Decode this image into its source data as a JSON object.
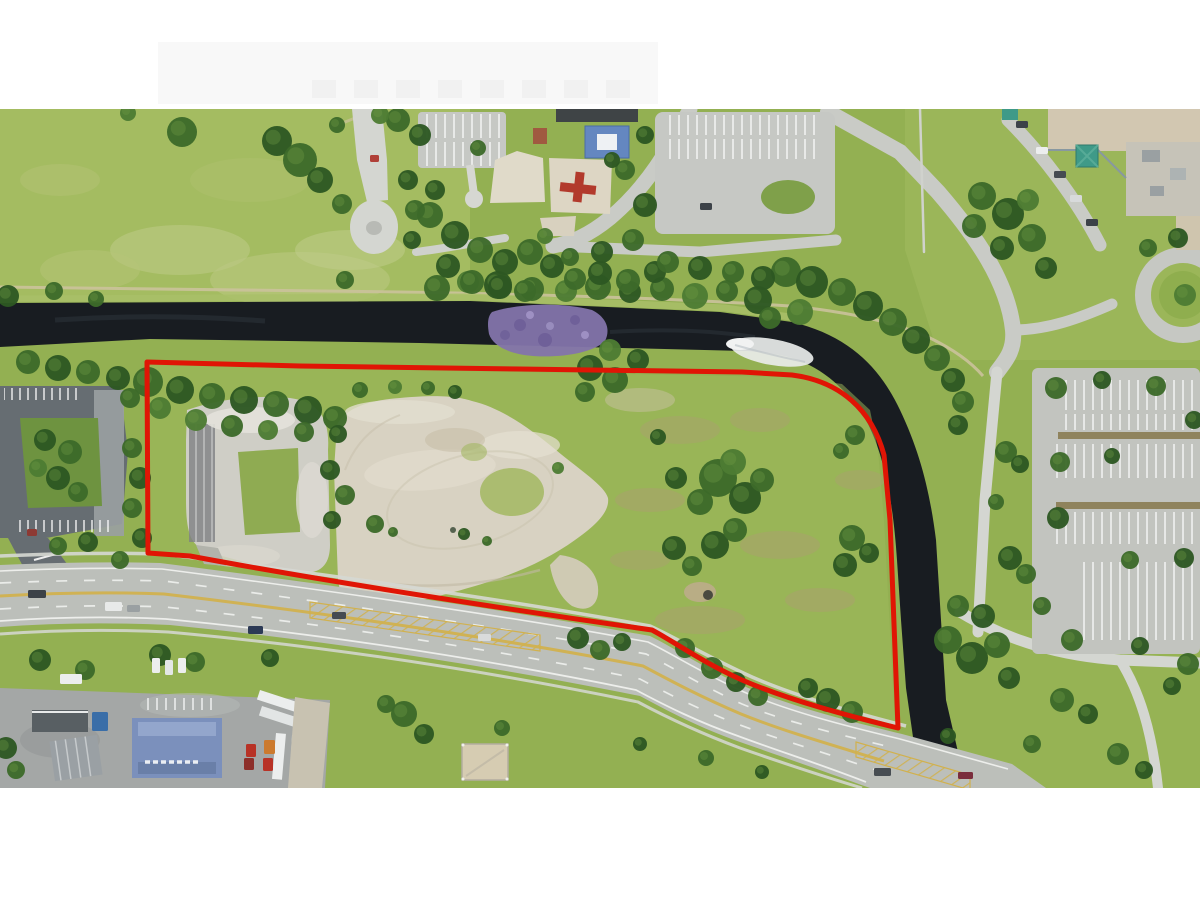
{
  "meta": {
    "description": "Aerial drone photograph of a vacant commercial land parcel outlined in red, bounded by a dark canal on the north and east, a multi-lane road on the south, with a public park, playground and parking lots surrounding it",
    "image_width": 1200,
    "image_height": 900,
    "photo_top": 109,
    "photo_bottom": 788
  },
  "annotation": {
    "type": "property-boundary",
    "color": "#e01505",
    "stroke_width": 5,
    "path": "M147,362 L300,366 L520,369 L742,372 L792,375 C840,381 872,410 884,455 L890,520 L898,728 C848,716 788,700 742,680 C702,662 678,644 652,630 C540,614 340,584 190,556 L148,553 Z"
  },
  "canal": {
    "color": "#181c21",
    "path": "M0,303 L470,301 L720,312 L792,322 C850,336 880,368 900,410 C920,452 930,492 936,540 L941,620 L946,700 L958,752 L972,788 L926,788 L914,744 L906,688 L901,620 L897,560 C893,500 884,456 868,424 C850,392 824,368 792,358 C770,352 750,351 744,351 L420,343 L150,339 L0,347 Z",
    "vegetation_color": "#8374ab",
    "whitewater_color": "#e9ebea"
  },
  "main_road": {
    "color": "#bcbfba",
    "path": "M0,565 Q90,561 160,563 C340,586 520,612 650,636 C678,650 704,668 746,687 C792,707 852,722 902,734 L1012,764 L1046,788 L870,788 C820,770 780,756 740,742 C700,728 670,712 640,696 C500,668 340,642 170,625 Q80,621 0,627 Z",
    "median_yellow": "#d1b14e",
    "marking_white": "#f2f3f1"
  },
  "parcel_interior": {
    "sand_color": "#d8d2c2",
    "sand_path": "M337,425 C345,408 370,400 400,398 C440,394 460,397 472,401 C502,408 532,430 556,450 C580,470 605,486 608,498 C610,512 595,526 575,540 C550,558 520,572 488,582 C450,594 410,604 380,607 C355,609 340,600 338,580 L334,470 Z",
    "sand_tail_path": "M560,555 C585,558 600,574 598,594 C596,608 585,612 572,606 C560,598 552,580 550,565 Z",
    "gravel_color": "#cfcec6"
  },
  "colors": {
    "grass_base": "#93b052",
    "field_light": "#a4bd62",
    "mottle_light": "#bcc983",
    "lawn_right": "#9cb75a",
    "path_gray": "#c9cbc6",
    "path_light": "#d4d6d1",
    "lot_light": "#c6c8c4",
    "lot_dark": "#666d72",
    "truck_yard": "#a4a7a6",
    "building_tan": "#d2c7b1",
    "building_gray": "#c6c3b8",
    "teal_roof": "#3f9a88",
    "blue_roof": "#7b90bc",
    "hedge_brown": "#8a7c52",
    "dirt_track": "#cbc29b",
    "brown_patch": "#ab9f70",
    "tree_shades": [
      "#2d5722",
      "#3c6a2a",
      "#4d7c33"
    ],
    "tree_highlight": "#6f9c44",
    "white_band": "#ffffff"
  },
  "trees": [
    [
      437,
      288,
      13,
      1
    ],
    [
      468,
      282,
      11,
      2
    ],
    [
      498,
      285,
      14,
      0
    ],
    [
      532,
      289,
      12,
      1
    ],
    [
      566,
      291,
      11,
      2
    ],
    [
      598,
      287,
      13,
      1
    ],
    [
      630,
      292,
      11,
      0
    ],
    [
      662,
      289,
      12,
      1
    ],
    [
      695,
      296,
      13,
      2
    ],
    [
      727,
      291,
      11,
      1
    ],
    [
      758,
      300,
      14,
      0
    ],
    [
      786,
      272,
      15,
      1
    ],
    [
      812,
      282,
      16,
      0
    ],
    [
      842,
      292,
      14,
      1
    ],
    [
      868,
      306,
      15,
      0
    ],
    [
      893,
      322,
      14,
      1
    ],
    [
      916,
      340,
      14,
      0
    ],
    [
      937,
      358,
      13,
      1
    ],
    [
      953,
      380,
      12,
      0
    ],
    [
      963,
      402,
      11,
      1
    ],
    [
      958,
      425,
      10,
      0
    ],
    [
      800,
      312,
      13,
      2
    ],
    [
      770,
      318,
      11,
      1
    ],
    [
      182,
      132,
      15,
      1
    ],
    [
      277,
      141,
      15,
      0
    ],
    [
      300,
      160,
      17,
      1
    ],
    [
      320,
      180,
      13,
      0
    ],
    [
      342,
      204,
      10,
      1
    ],
    [
      8,
      296,
      11,
      0
    ],
    [
      54,
      291,
      9,
      1
    ],
    [
      96,
      299,
      8,
      1
    ],
    [
      128,
      113,
      8,
      2
    ],
    [
      345,
      280,
      9,
      1
    ],
    [
      398,
      120,
      12,
      1
    ],
    [
      420,
      135,
      11,
      0
    ],
    [
      380,
      115,
      9,
      2
    ],
    [
      337,
      125,
      8,
      1
    ],
    [
      430,
      215,
      13,
      1
    ],
    [
      455,
      235,
      14,
      0
    ],
    [
      480,
      250,
      13,
      1
    ],
    [
      505,
      262,
      13,
      0
    ],
    [
      530,
      252,
      13,
      1
    ],
    [
      448,
      266,
      12,
      0
    ],
    [
      472,
      282,
      12,
      1
    ],
    [
      500,
      287,
      12,
      0
    ],
    [
      525,
      291,
      11,
      1
    ],
    [
      552,
      266,
      12,
      0
    ],
    [
      575,
      279,
      11,
      1
    ],
    [
      435,
      190,
      10,
      0
    ],
    [
      408,
      180,
      10,
      0
    ],
    [
      415,
      210,
      10,
      1
    ],
    [
      412,
      240,
      9,
      0
    ],
    [
      600,
      273,
      12,
      0
    ],
    [
      628,
      281,
      12,
      1
    ],
    [
      655,
      272,
      11,
      0
    ],
    [
      668,
      262,
      11,
      1
    ],
    [
      700,
      268,
      12,
      0
    ],
    [
      733,
      272,
      11,
      1
    ],
    [
      763,
      278,
      12,
      0
    ],
    [
      478,
      148,
      8,
      1
    ],
    [
      625,
      170,
      10,
      1
    ],
    [
      645,
      205,
      12,
      0
    ],
    [
      633,
      240,
      11,
      1
    ],
    [
      602,
      252,
      11,
      0
    ],
    [
      570,
      257,
      9,
      1
    ],
    [
      545,
      236,
      8,
      2
    ],
    [
      612,
      160,
      8,
      0
    ],
    [
      645,
      135,
      9,
      0
    ],
    [
      28,
      362,
      12,
      1
    ],
    [
      58,
      368,
      13,
      0
    ],
    [
      88,
      372,
      12,
      1
    ],
    [
      118,
      378,
      12,
      0
    ],
    [
      148,
      382,
      15,
      1
    ],
    [
      180,
      390,
      14,
      0
    ],
    [
      212,
      396,
      13,
      1
    ],
    [
      244,
      400,
      14,
      0
    ],
    [
      276,
      404,
      13,
      1
    ],
    [
      308,
      410,
      14,
      0
    ],
    [
      335,
      418,
      12,
      1
    ],
    [
      196,
      420,
      11,
      2
    ],
    [
      232,
      426,
      11,
      1
    ],
    [
      268,
      430,
      10,
      2
    ],
    [
      304,
      432,
      10,
      1
    ],
    [
      338,
      434,
      9,
      0
    ],
    [
      160,
      408,
      11,
      2
    ],
    [
      130,
      398,
      10,
      1
    ],
    [
      360,
      390,
      8,
      1
    ],
    [
      395,
      387,
      7,
      2
    ],
    [
      428,
      388,
      7,
      1
    ],
    [
      455,
      392,
      7,
      0
    ],
    [
      590,
      368,
      13,
      0
    ],
    [
      615,
      380,
      13,
      1
    ],
    [
      638,
      360,
      11,
      0
    ],
    [
      610,
      350,
      11,
      2
    ],
    [
      585,
      392,
      10,
      1
    ],
    [
      330,
      470,
      10,
      0
    ],
    [
      345,
      495,
      10,
      1
    ],
    [
      332,
      520,
      9,
      0
    ],
    [
      132,
      448,
      10,
      1
    ],
    [
      140,
      478,
      11,
      0
    ],
    [
      132,
      508,
      10,
      1
    ],
    [
      142,
      538,
      10,
      0
    ],
    [
      120,
      560,
      9,
      1
    ],
    [
      45,
      440,
      11,
      0
    ],
    [
      70,
      452,
      12,
      1
    ],
    [
      58,
      478,
      12,
      0
    ],
    [
      78,
      492,
      10,
      1
    ],
    [
      38,
      468,
      9,
      2
    ],
    [
      58,
      546,
      9,
      1
    ],
    [
      88,
      542,
      10,
      0
    ],
    [
      718,
      478,
      19,
      1
    ],
    [
      745,
      498,
      16,
      0
    ],
    [
      700,
      502,
      13,
      1
    ],
    [
      733,
      462,
      13,
      2
    ],
    [
      762,
      480,
      12,
      1
    ],
    [
      715,
      545,
      14,
      0
    ],
    [
      735,
      530,
      12,
      1
    ],
    [
      674,
      548,
      12,
      0
    ],
    [
      692,
      566,
      10,
      1
    ],
    [
      676,
      478,
      11,
      0
    ],
    [
      852,
      538,
      13,
      1
    ],
    [
      869,
      553,
      10,
      0
    ],
    [
      845,
      565,
      12,
      0
    ],
    [
      658,
      437,
      8,
      0
    ],
    [
      841,
      451,
      8,
      1
    ],
    [
      855,
      435,
      10,
      1
    ],
    [
      464,
      534,
      6,
      0
    ],
    [
      487,
      541,
      5,
      1
    ],
    [
      375,
      524,
      9,
      1
    ],
    [
      393,
      532,
      5,
      1
    ],
    [
      558,
      468,
      6,
      2
    ],
    [
      685,
      648,
      10,
      1
    ],
    [
      578,
      638,
      11,
      0
    ],
    [
      600,
      650,
      10,
      1
    ],
    [
      622,
      642,
      9,
      0
    ],
    [
      712,
      668,
      11,
      1
    ],
    [
      736,
      682,
      10,
      0
    ],
    [
      758,
      696,
      10,
      1
    ],
    [
      828,
      700,
      12,
      0
    ],
    [
      852,
      712,
      11,
      1
    ],
    [
      808,
      688,
      10,
      0
    ],
    [
      948,
      640,
      14,
      1
    ],
    [
      972,
      658,
      16,
      0
    ],
    [
      997,
      645,
      13,
      1
    ],
    [
      983,
      616,
      12,
      0
    ],
    [
      958,
      606,
      11,
      1
    ],
    [
      1009,
      678,
      11,
      0
    ],
    [
      1006,
      452,
      11,
      1
    ],
    [
      1020,
      464,
      9,
      0
    ],
    [
      1010,
      558,
      12,
      0
    ],
    [
      1026,
      574,
      10,
      1
    ],
    [
      996,
      502,
      8,
      1
    ],
    [
      1056,
      388,
      11,
      1
    ],
    [
      1102,
      380,
      9,
      0
    ],
    [
      1156,
      386,
      10,
      1
    ],
    [
      1194,
      420,
      9,
      0
    ],
    [
      1060,
      462,
      10,
      1
    ],
    [
      1112,
      456,
      8,
      0
    ],
    [
      1058,
      518,
      11,
      0
    ],
    [
      1130,
      560,
      9,
      1
    ],
    [
      1184,
      558,
      10,
      0
    ],
    [
      1072,
      640,
      11,
      1
    ],
    [
      1140,
      646,
      9,
      0
    ],
    [
      1042,
      606,
      9,
      1
    ],
    [
      982,
      196,
      14,
      1
    ],
    [
      1008,
      214,
      16,
      0
    ],
    [
      1032,
      238,
      14,
      1
    ],
    [
      1002,
      248,
      12,
      0
    ],
    [
      974,
      226,
      12,
      1
    ],
    [
      1046,
      268,
      11,
      0
    ],
    [
      1028,
      200,
      11,
      2
    ],
    [
      1148,
      248,
      9,
      1
    ],
    [
      1178,
      238,
      10,
      0
    ],
    [
      1185,
      295,
      11,
      2
    ],
    [
      1062,
      700,
      12,
      1
    ],
    [
      1088,
      714,
      10,
      0
    ],
    [
      1118,
      754,
      11,
      1
    ],
    [
      1144,
      770,
      9,
      0
    ],
    [
      1188,
      664,
      11,
      1
    ],
    [
      1172,
      686,
      9,
      0
    ],
    [
      1032,
      744,
      9,
      1
    ],
    [
      948,
      736,
      8,
      0
    ],
    [
      404,
      714,
      13,
      1
    ],
    [
      424,
      734,
      10,
      0
    ],
    [
      386,
      704,
      9,
      1
    ],
    [
      6,
      748,
      11,
      0
    ],
    [
      16,
      770,
      9,
      1
    ],
    [
      40,
      660,
      11,
      0
    ],
    [
      85,
      670,
      10,
      1
    ],
    [
      160,
      655,
      11,
      0
    ],
    [
      195,
      662,
      10,
      1
    ],
    [
      270,
      658,
      9,
      0
    ],
    [
      502,
      728,
      8,
      1
    ],
    [
      640,
      744,
      7,
      0
    ],
    [
      706,
      758,
      8,
      1
    ],
    [
      762,
      772,
      7,
      0
    ]
  ],
  "vehicles": [
    [
      28,
      590,
      18,
      8,
      "#3c4248"
    ],
    [
      105,
      602,
      17,
      9,
      "#e8eae9"
    ],
    [
      127,
      605,
      13,
      7,
      "#9aa0a2"
    ],
    [
      248,
      626,
      15,
      8,
      "#2c3a55"
    ],
    [
      332,
      612,
      14,
      7,
      "#454b52"
    ],
    [
      478,
      634,
      13,
      7,
      "#d9dbdb"
    ],
    [
      874,
      768,
      17,
      8,
      "#474d52"
    ],
    [
      958,
      772,
      15,
      7,
      "#7a2d3c"
    ],
    [
      60,
      674,
      22,
      10,
      "#eceeee"
    ],
    [
      152,
      658,
      8,
      15,
      "#eceeee"
    ],
    [
      165,
      660,
      8,
      15,
      "#e4e7e7"
    ],
    [
      178,
      658,
      8,
      15,
      "#eceeee"
    ],
    [
      92,
      712,
      16,
      19,
      "#3a6ea8"
    ],
    [
      246,
      744,
      10,
      13,
      "#b83226"
    ],
    [
      264,
      740,
      11,
      14,
      "#cc7a2e"
    ],
    [
      263,
      758,
      10,
      13,
      "#b83226"
    ],
    [
      244,
      758,
      10,
      12,
      "#8d2f2a"
    ],
    [
      27,
      529,
      10,
      7,
      "#8d3a34"
    ],
    [
      700,
      203,
      12,
      7,
      "#3c4248"
    ],
    [
      1016,
      121,
      12,
      7,
      "#3c4248"
    ],
    [
      1036,
      147,
      12,
      7,
      "#eceeee"
    ],
    [
      1054,
      171,
      12,
      7,
      "#454b52"
    ],
    [
      1070,
      195,
      12,
      7,
      "#d8dadb"
    ],
    [
      1086,
      219,
      12,
      7,
      "#3c4248"
    ],
    [
      370,
      155,
      9,
      7,
      "#b04038"
    ]
  ]
}
